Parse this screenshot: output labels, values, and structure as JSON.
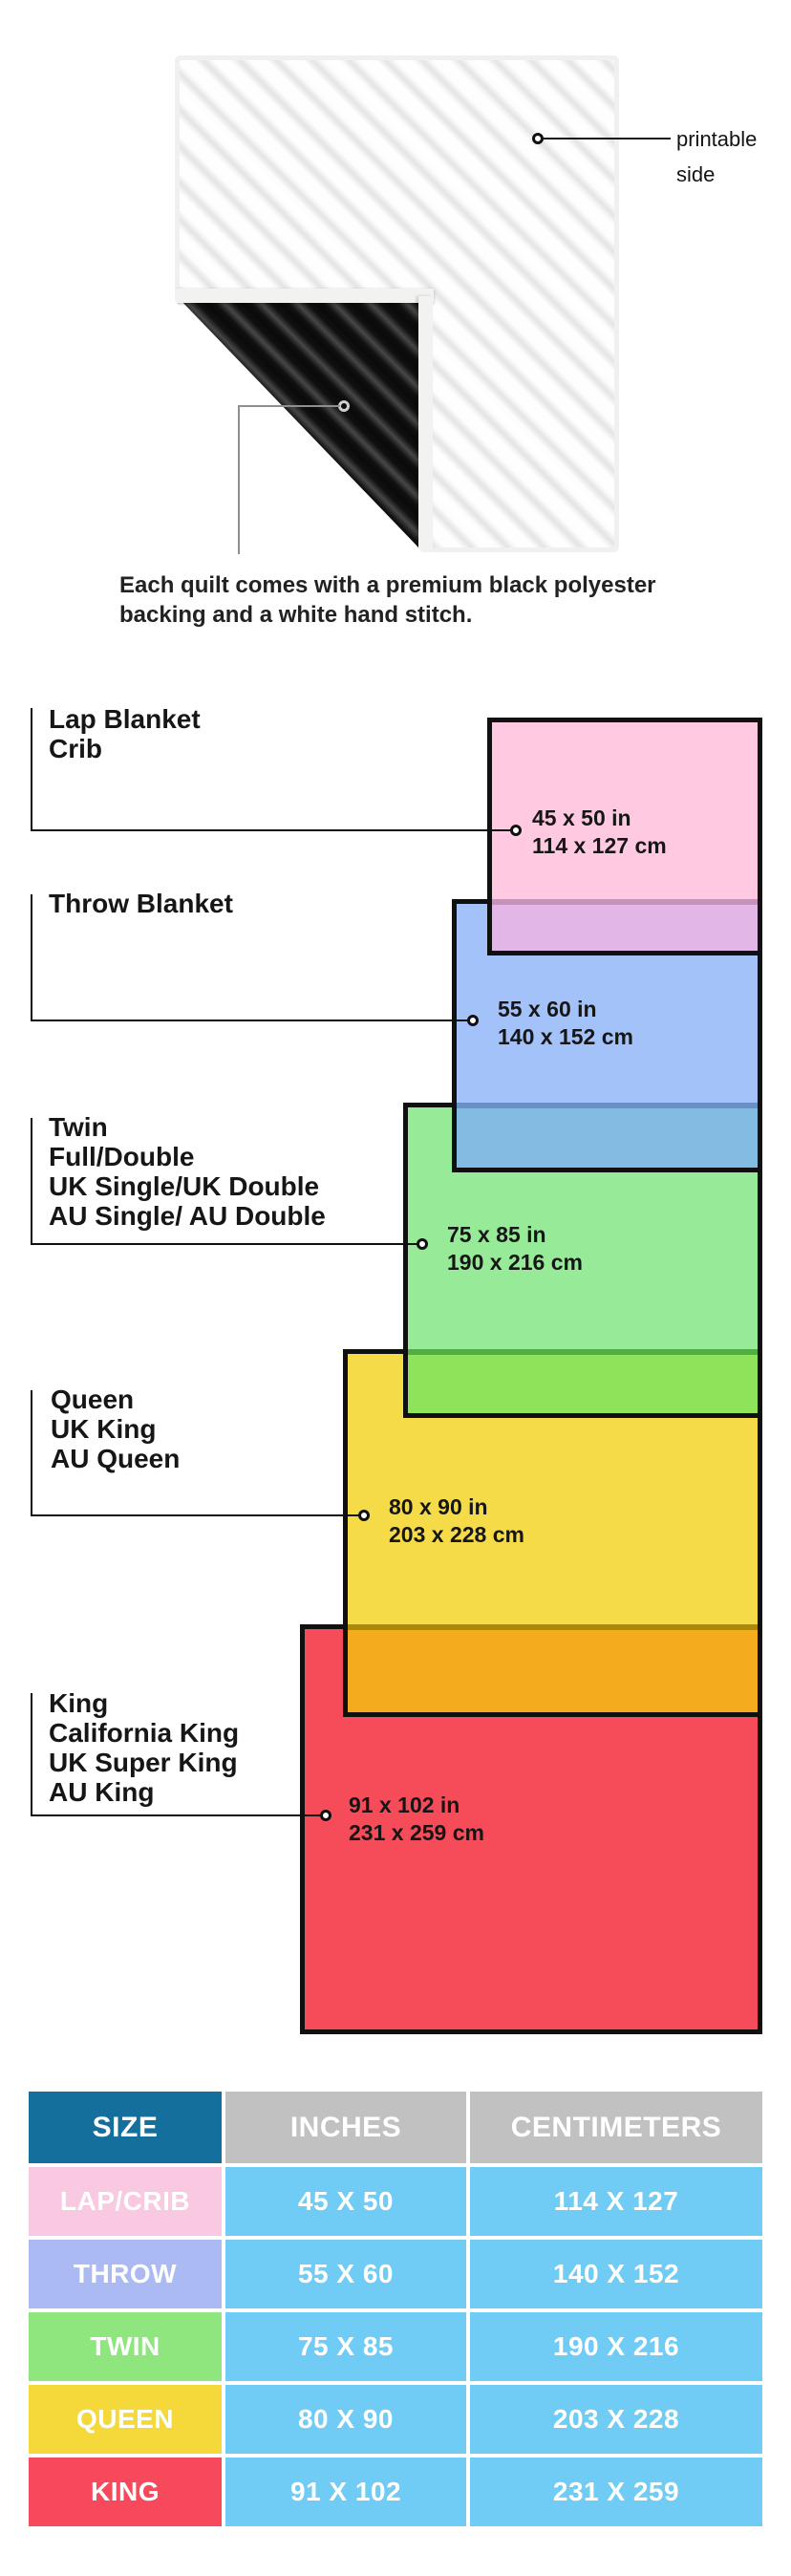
{
  "page": {
    "background": "#ffffff"
  },
  "quilt_section": {
    "printable_label_lines": [
      "printable",
      "side"
    ],
    "caption_lines": [
      "Each quilt comes with a premium black polyester",
      "backing and a white hand stitch."
    ]
  },
  "diagram": {
    "border_color": "#101010",
    "items": [
      {
        "id": "lap-crib",
        "label_lines": [
          "Lap Blanket",
          "Crib"
        ],
        "size_in": "45 x 50 in",
        "size_cm": "114 x 127 cm",
        "fill": "#ffcae1",
        "overlap_fill": "#e2b6e7",
        "overlap_edge": "#c493bb"
      },
      {
        "id": "throw",
        "label_lines": [
          "Throw Blanket"
        ],
        "size_in": "55 x 60 in",
        "size_cm": "140 x 152 cm",
        "fill": "#a3c2fa",
        "overlap_fill": "#82bce2",
        "overlap_edge": "#6a90c6"
      },
      {
        "id": "twin",
        "label_lines": [
          "Twin",
          "Full/Double",
          "UK Single/UK Double",
          "AU Single/ AU Double"
        ],
        "size_in": "75 x 85 in",
        "size_cm": "190 x 216 cm",
        "fill": "#97ea98",
        "overlap_fill": "#8fe35b",
        "overlap_edge": "#4fae44"
      },
      {
        "id": "queen",
        "label_lines": [
          "Queen",
          "UK King",
          "AU Queen"
        ],
        "size_in": "80 x 90 in",
        "size_cm": "203 x 228 cm",
        "fill": "#f6db49",
        "overlap_fill": "#f4ab1e",
        "overlap_edge": "#a98a0a"
      },
      {
        "id": "king",
        "label_lines": [
          "King",
          "California King",
          "UK Super King",
          "AU King"
        ],
        "size_in": "91 x 102 in",
        "size_cm": "231 x 259 cm",
        "fill": "#f64b59",
        "overlap_fill": null,
        "overlap_edge": null
      }
    ]
  },
  "table": {
    "headers": [
      "SIZE",
      "INCHES",
      "CENTIMETERS"
    ],
    "header_colors": {
      "size": "#156f9d",
      "measure": "#c2c1c1"
    },
    "cell_color": "#70ccf5",
    "text_color": "#ffffff",
    "rows": [
      {
        "size": "LAP/CRIB",
        "inches": "45 X 50",
        "centimeters": "114 X 127",
        "color": "#f9c9e1"
      },
      {
        "size": "THROW",
        "inches": "55 X 60",
        "centimeters": "140 X 152",
        "color": "#abbaf3"
      },
      {
        "size": "TWIN",
        "inches": "75 X 85",
        "centimeters": "190 X 216",
        "color": "#8fe57e"
      },
      {
        "size": "QUEEN",
        "inches": "80 X 90",
        "centimeters": "203 X 228",
        "color": "#f5d93b"
      },
      {
        "size": "KING",
        "inches": "91 X 102",
        "centimeters": "231 X 259",
        "color": "#f6495c"
      }
    ]
  }
}
